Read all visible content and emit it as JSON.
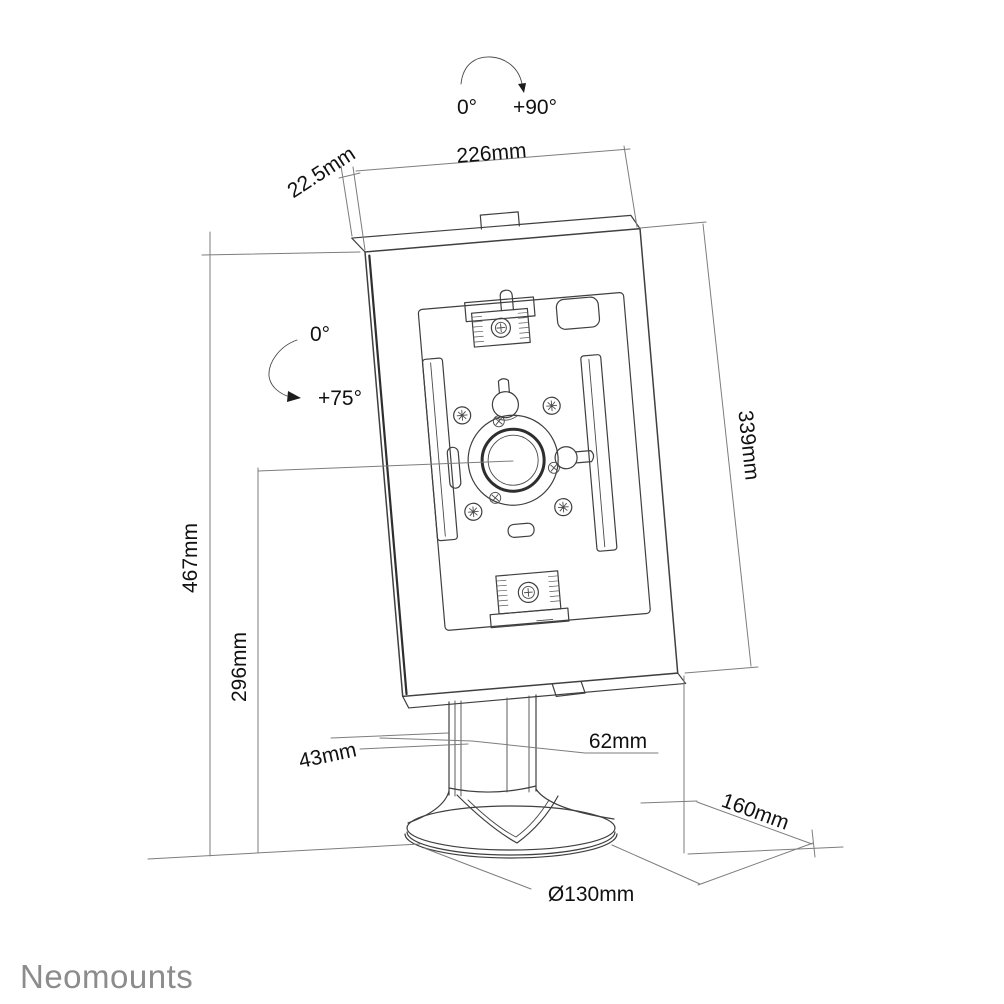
{
  "drawing": {
    "brand": "Neomounts",
    "product": "tablet-floor-stand-dimension-drawing",
    "rotation_range": {
      "from": "0°",
      "to": "+90°"
    },
    "tilt_range": {
      "from": "0°",
      "to": "+75°"
    },
    "dimensions": {
      "enclosure_width": "226mm",
      "enclosure_thickness": "22.5mm",
      "total_height": "467mm",
      "center_height": "296mm",
      "enclosure_height": "339mm",
      "pole_width": "43mm",
      "pole_depth": "62mm",
      "base_depth": "160mm",
      "base_diameter": "Ø130mm"
    },
    "colors": {
      "line": "#3f3f3f",
      "dimension_line": "#7d7d7d",
      "label_text": "#111111",
      "logo": "#8c8c8c",
      "background": "#ffffff"
    }
  }
}
